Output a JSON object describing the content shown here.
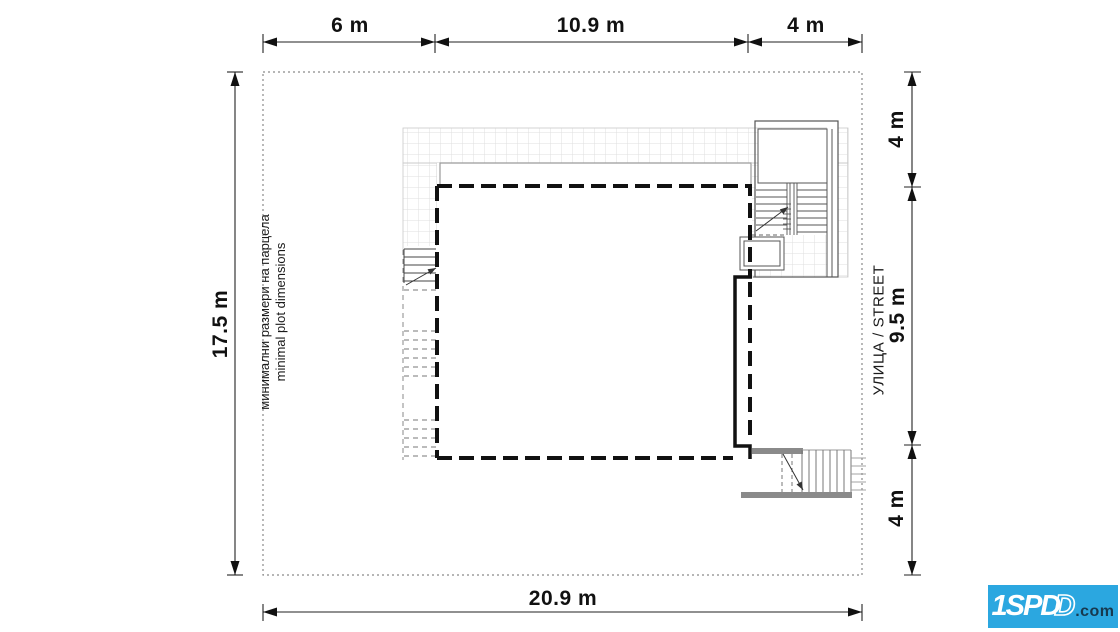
{
  "title": "minimal plot dimensions site plan",
  "dimensions": {
    "top": {
      "segments": [
        {
          "label": "6 m"
        },
        {
          "label": "10.9 m"
        },
        {
          "label": "4 m"
        }
      ]
    },
    "bottom": {
      "label": "20.9 m"
    },
    "left": {
      "label": "17.5 m"
    },
    "right": {
      "segments": [
        {
          "label": "4 m"
        },
        {
          "label": "9.5 m"
        },
        {
          "label": "4 m"
        }
      ]
    }
  },
  "labels": {
    "plot_bg": "минимални размери на парцела",
    "plot_en": "minimal plot dimensions",
    "street": "УЛИЦА / STREET"
  },
  "logo": {
    "main": "1SPD",
    "outline": "D",
    "suffix": ".com",
    "background": "#2ba7e0",
    "suffix_color": "#17394f"
  },
  "colors": {
    "bold_line": "#111111",
    "thin_line": "#555555",
    "grid_line": "#dfdfdf",
    "boundary_dotted": "#8a8a8a",
    "stair_wall_gray": "#8a8a8a"
  }
}
